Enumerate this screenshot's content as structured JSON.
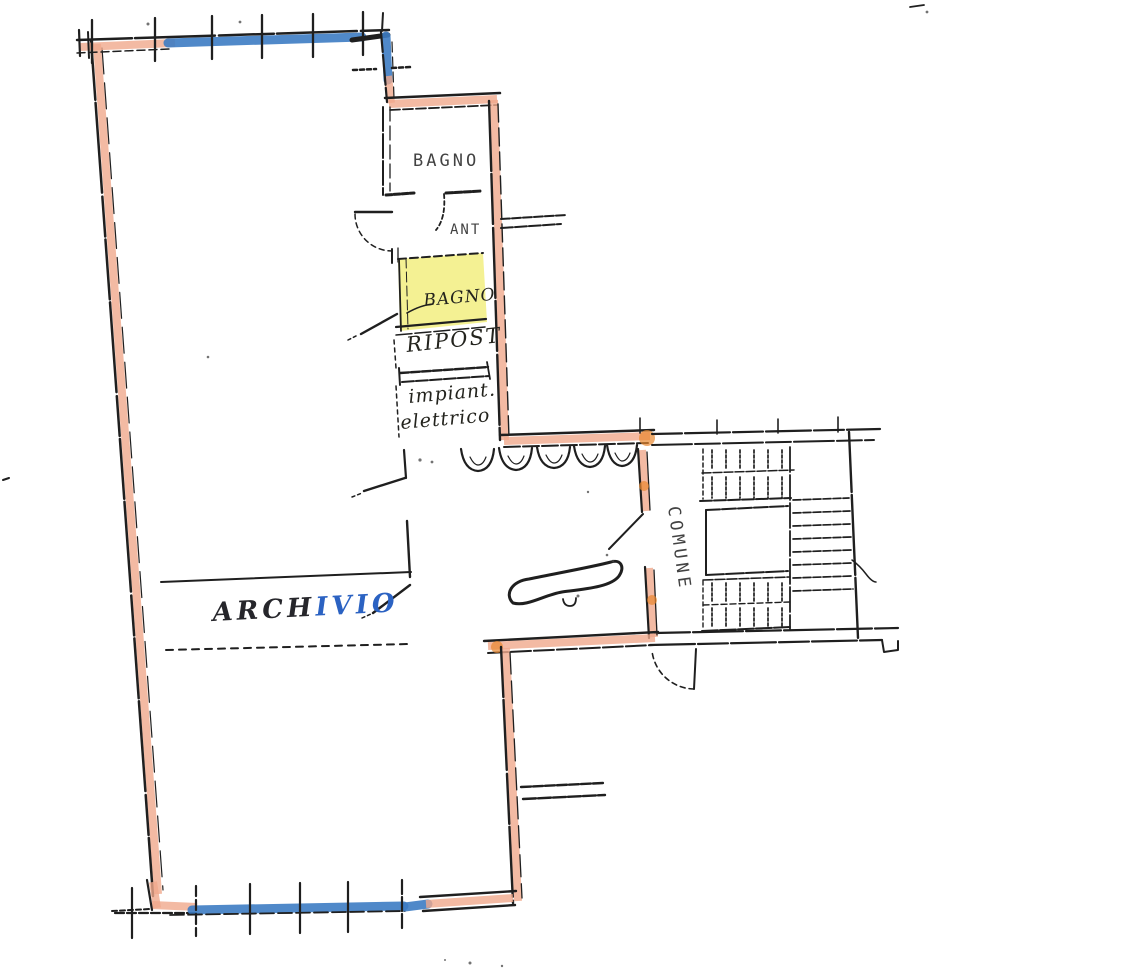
{
  "document": {
    "kind": "scanned-floor-plan",
    "page_background": "#ffffff"
  },
  "colors": {
    "ink": "#1f1f1f",
    "wall_highlight": "#f0a98c",
    "window_highlight": "#3d7cc3",
    "room_highlight": "#f1ee7b",
    "accent_orange": "#e8872f",
    "handwriting_dark": "#26262b",
    "handwriting_blue": "#2b62c2",
    "paper": "#ffffff"
  },
  "labels": {
    "bagno_top": "BAGNO",
    "anti": "ANT",
    "bagno_small": "BAGNO",
    "ripostiglio": "RIPOST",
    "impianto_line1": "impiant.",
    "impianto_line2": "elettrico",
    "archivio_part1": "ARCH",
    "archivio_part2": "IVIO",
    "comune": "COMUNE"
  },
  "fixtures": {
    "sink_count": 5,
    "stair_upper_tread_lines": 6,
    "stair_side_tread_lines": 8,
    "stair_lower_tread_lines": 6
  }
}
